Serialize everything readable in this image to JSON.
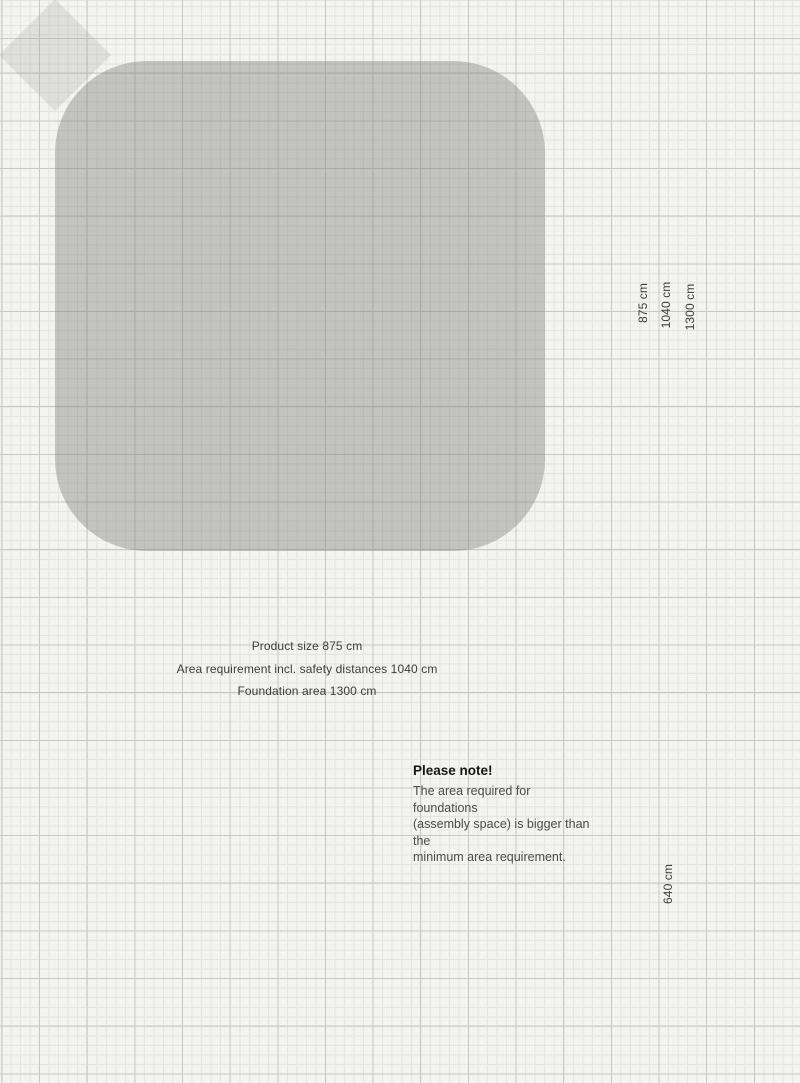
{
  "colors": {
    "dimension_red": "#d23428",
    "dimension_blue": "#42a0d6",
    "net_red": "#b3473c",
    "rope_dark": "#4c4c4c",
    "hub_red": "#8c2b22",
    "hub_ring": "#5f1d16",
    "mast_gray": "#b6b6b6",
    "mast_cap_red": "#7c2a23",
    "safety_area_gray": "rgba(122,122,122,0.40)",
    "foundation_pad_gray": "rgba(150,150,150,0.22)",
    "foundation_block_gray": "rgba(140,140,140,0.28)"
  },
  "dimensions": {
    "vertical_875": "875 cm",
    "vertical_1040": "1040 cm",
    "vertical_1300": "1300 cm",
    "side_height_640": "640 cm",
    "product_size": "Product size 875 cm",
    "area_requirement": "Area requirement incl. safety distances 1040 cm",
    "foundation_area": "Foundation area 1300 cm"
  },
  "note": {
    "title": "Please note!",
    "line1": "The area required for foundations",
    "line2": "(assembly space) is bigger than the",
    "line3": "minimum area requirement."
  }
}
